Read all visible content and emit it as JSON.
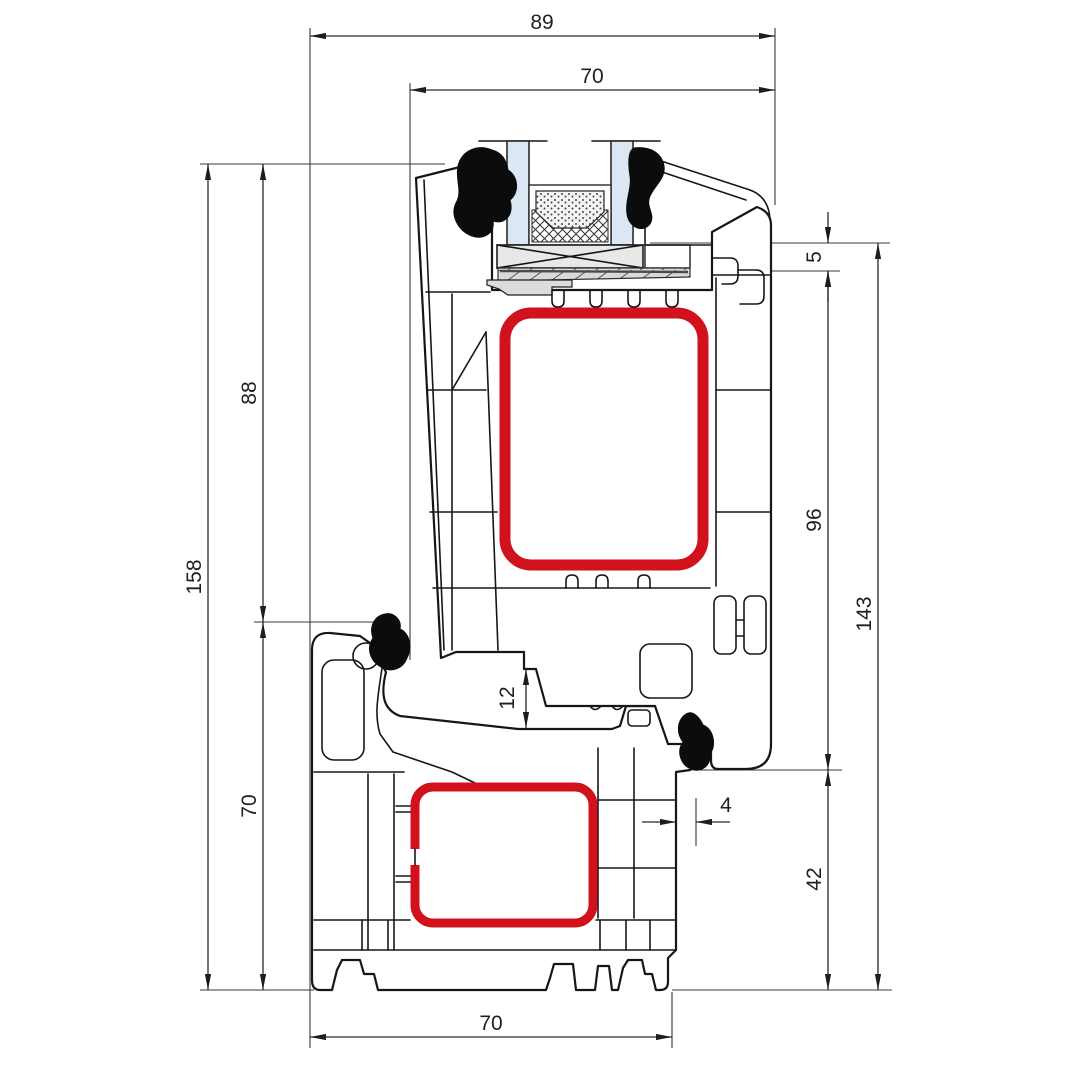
{
  "drawing": {
    "subject": "pvc-window-frame-and-sash-cross-section",
    "unit": "mm",
    "dims": {
      "d89": "89",
      "d70_top": "70",
      "d158": "158",
      "d88": "88",
      "d70_left": "70",
      "d5": "5",
      "d96": "96",
      "d143": "143",
      "d42": "42",
      "d12": "12",
      "d4": "4",
      "d70_bottom": "70"
    },
    "colors": {
      "line": "#161616",
      "dimension": "#2a2a2a",
      "steel_reinforcement": "#d1111b",
      "glass": "#dbe8f4",
      "packer": "#e8e8e8",
      "bridge": "#d9d9d9",
      "gasket": "#0c0c0c",
      "background": "#ffffff"
    },
    "parts": [
      "outer-frame-profile",
      "sash-profile",
      "steel-reinforcement-sash",
      "steel-reinforcement-frame",
      "double-glazing-panes",
      "glass-spacer-desiccant",
      "glazing-packer",
      "rubber-gaskets"
    ]
  }
}
